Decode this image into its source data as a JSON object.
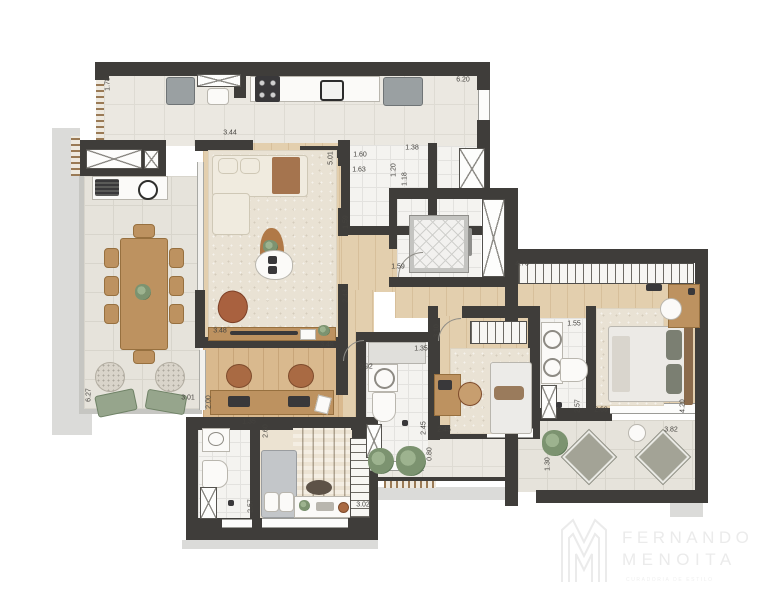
{
  "plan": {
    "type": "apartment-floor-plan",
    "units": "meters",
    "dimensions": [
      {
        "value": "1.78",
        "x": 108,
        "y": 84,
        "rot": 90
      },
      {
        "value": "3.44",
        "x": 230,
        "y": 133,
        "rot": 0
      },
      {
        "value": "6.20",
        "x": 463,
        "y": 80,
        "rot": 0
      },
      {
        "value": "1.60",
        "x": 360,
        "y": 155,
        "rot": 0
      },
      {
        "value": "1.63",
        "x": 359,
        "y": 170,
        "rot": 0
      },
      {
        "value": "5.01",
        "x": 331,
        "y": 158,
        "rot": 90
      },
      {
        "value": "1.38",
        "x": 412,
        "y": 148,
        "rot": 0
      },
      {
        "value": "1.20",
        "x": 394,
        "y": 170,
        "rot": 90
      },
      {
        "value": "1.18",
        "x": 405,
        "y": 179,
        "rot": 90
      },
      {
        "value": "1.59",
        "x": 346,
        "y": 222,
        "rot": 90
      },
      {
        "value": "1.59",
        "x": 398,
        "y": 267,
        "rot": 0
      },
      {
        "value": "2.43",
        "x": 346,
        "y": 296,
        "rot": 90
      },
      {
        "value": "3.48",
        "x": 220,
        "y": 331,
        "rot": 0
      },
      {
        "value": "3.48",
        "x": 327,
        "y": 345,
        "rot": 0
      },
      {
        "value": "3.10",
        "x": 437,
        "y": 331,
        "rot": 90
      },
      {
        "value": "1.35",
        "x": 421,
        "y": 349,
        "rot": 0
      },
      {
        "value": "0.92",
        "x": 366,
        "y": 367,
        "rot": 0
      },
      {
        "value": "2.00",
        "x": 209,
        "y": 402,
        "rot": 90
      },
      {
        "value": "6.27",
        "x": 89,
        "y": 395,
        "rot": 90
      },
      {
        "value": "3.01",
        "x": 188,
        "y": 398,
        "rot": 0
      },
      {
        "value": "1.35",
        "x": 249,
        "y": 422,
        "rot": 0
      },
      {
        "value": "2.60",
        "x": 266,
        "y": 431,
        "rot": 90
      },
      {
        "value": "2.45",
        "x": 424,
        "y": 428,
        "rot": 90
      },
      {
        "value": "2.45",
        "x": 444,
        "y": 430,
        "rot": 0
      },
      {
        "value": "0.80",
        "x": 430,
        "y": 454,
        "rot": 90
      },
      {
        "value": "2.57",
        "x": 251,
        "y": 506,
        "rot": 90
      },
      {
        "value": "3.02",
        "x": 363,
        "y": 505,
        "rot": 0
      },
      {
        "value": "1.30",
        "x": 548,
        "y": 464,
        "rot": 90
      },
      {
        "value": "1.55",
        "x": 574,
        "y": 324,
        "rot": 0
      },
      {
        "value": "4.76",
        "x": 522,
        "y": 264,
        "rot": 0
      },
      {
        "value": "2.57",
        "x": 578,
        "y": 406,
        "rot": 90
      },
      {
        "value": "2.69",
        "x": 601,
        "y": 410,
        "rot": 0
      },
      {
        "value": "4.20",
        "x": 683,
        "y": 406,
        "rot": 90
      },
      {
        "value": "3.82",
        "x": 671,
        "y": 430,
        "rot": 0
      }
    ]
  },
  "logo": {
    "line1": "FERNANDO",
    "line2": "MENOITA",
    "tagline": "CURADORIA DE ESTILO"
  },
  "colors": {
    "wall": "#3f3d3a",
    "floor_tile": "#ebe8e1",
    "terrace_tile": "#e6e3db",
    "wood_light": "#e3cfae",
    "wood_dark": "#d9b98e",
    "bath_tile": "#f4f3f0",
    "rug": "#e9e2d4",
    "slab_shadow": "#dbdbd9",
    "plant_green": "#7c9370",
    "terracotta": "#a96a43",
    "logo_gray": "#ebebeb"
  }
}
